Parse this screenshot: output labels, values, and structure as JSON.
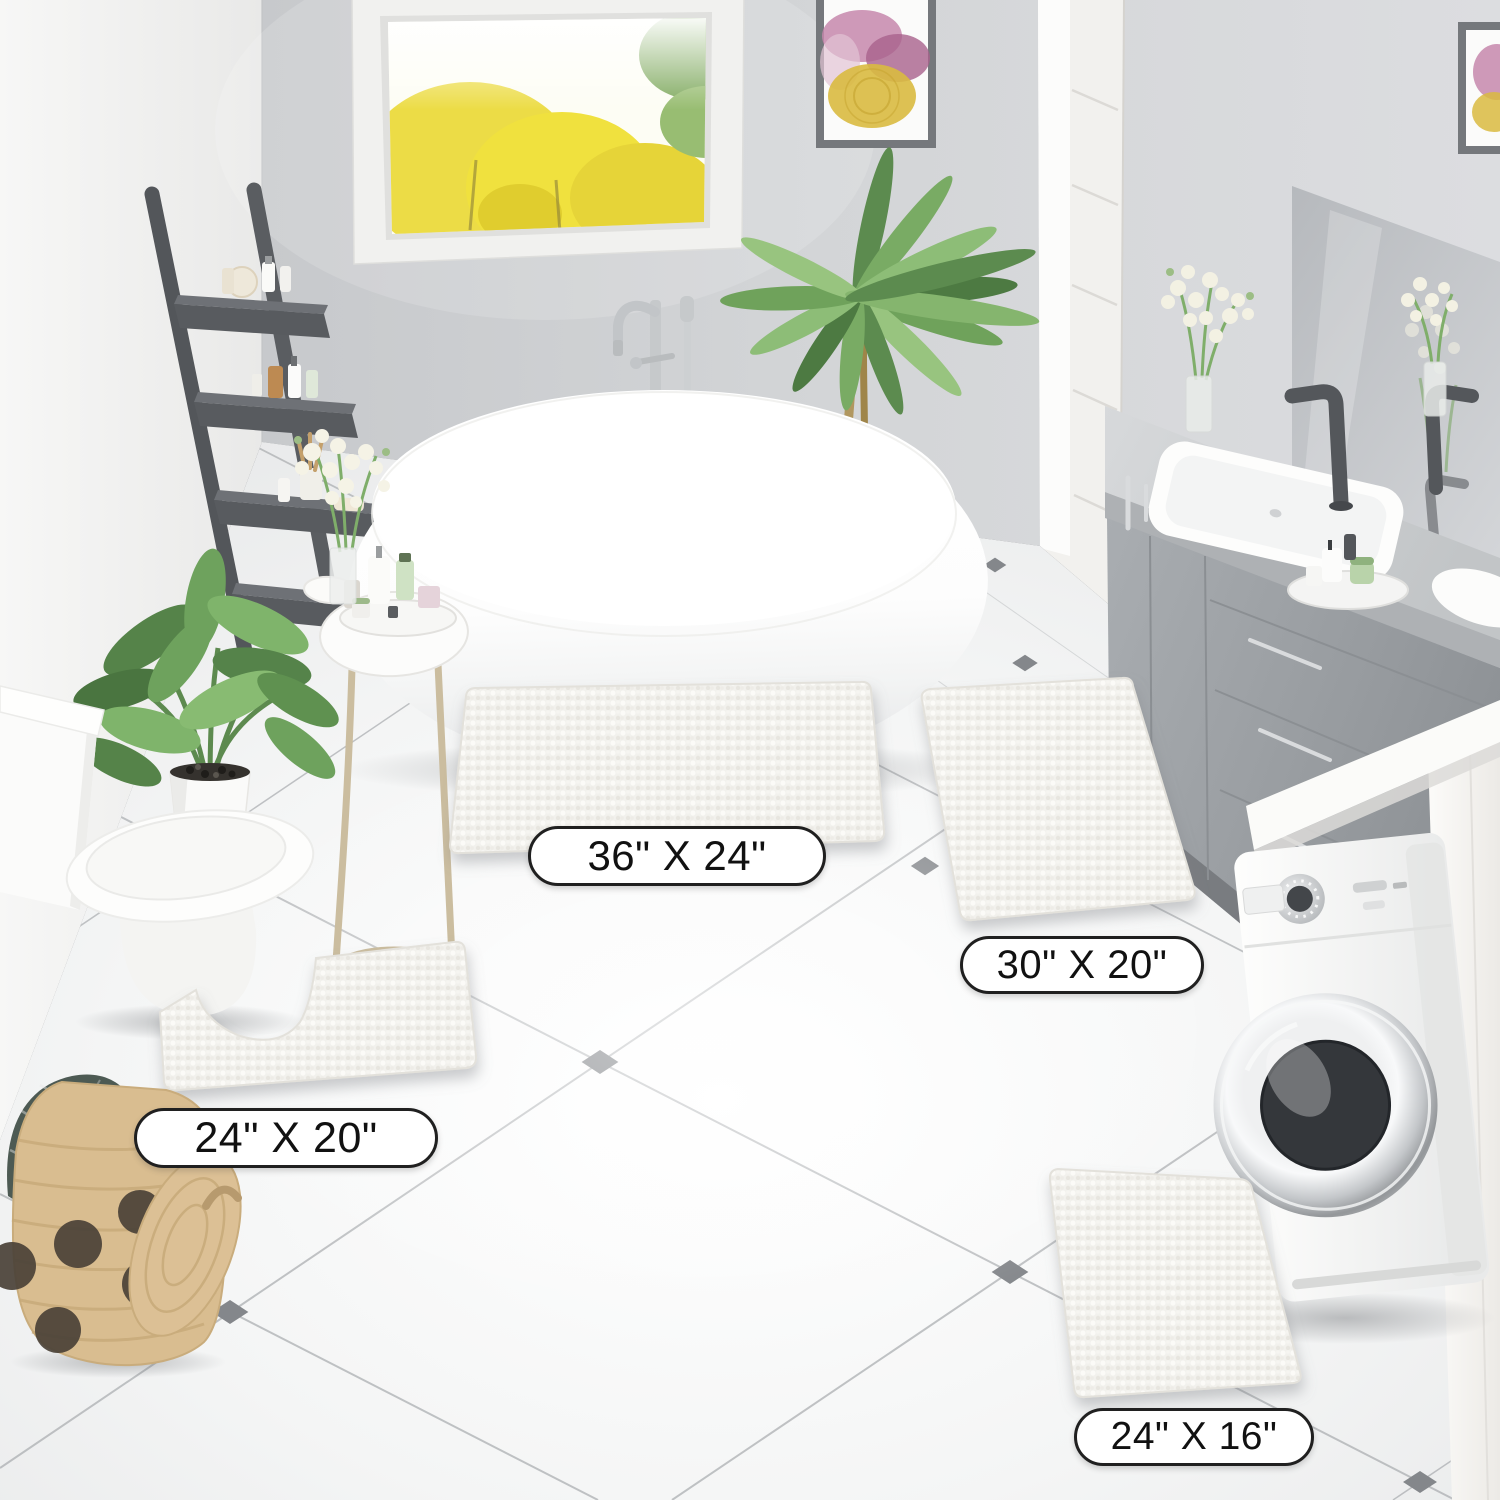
{
  "rugs": [
    {
      "id": "rug-large",
      "size_label": "36\" X 24\""
    },
    {
      "id": "rug-runner",
      "size_label": "30\" X 20\""
    },
    {
      "id": "rug-contour",
      "size_label": "24\" X 20\""
    },
    {
      "id": "rug-small",
      "size_label": "24\" X 16\""
    }
  ],
  "colors": {
    "rug_white": "#f2f1ed",
    "wall_back": "#d3d5d7",
    "wall_left": "#f3f3f2",
    "floor_white": "#f6f7f7",
    "tile_line": "#a8abae",
    "tile_accent_diamond": "#84878b",
    "baseboard_dark": "#63666a",
    "vanity_gray": "#9b9fa3",
    "faucet_dark_gray": "#54575b",
    "chrome": "#c6c9cc",
    "basket_tan": "#d9bd90",
    "basket_dot_brown": "#4b4238",
    "plant_green": "#6ea25d",
    "window_foliage_yellow": "#ecdc46",
    "artwork_pink": "#c687ab",
    "artwork_gold": "#d9ba40",
    "label_background": "#ffffff",
    "label_border": "#202020",
    "label_text": "#111111"
  }
}
